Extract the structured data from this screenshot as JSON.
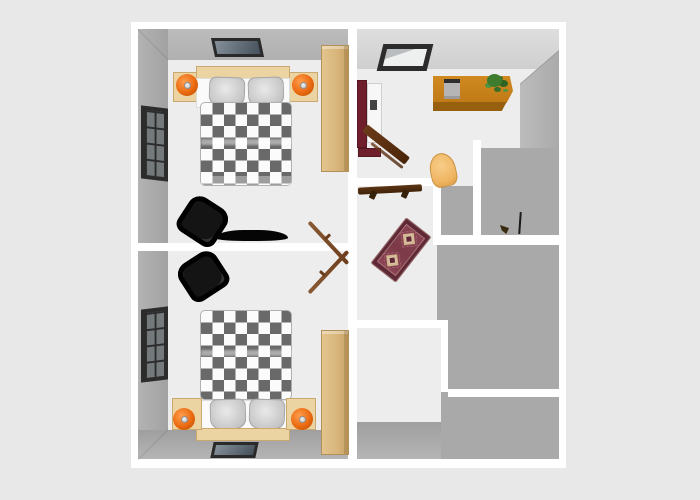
{
  "meta": {
    "description": "3D overhead rendering of an upper-storey floor plan on a plain light-gray background; no visible text, labels or UI controls anywhere in the image",
    "canvas": {
      "width": 700,
      "height": 500
    },
    "plan_outline": {
      "left": 131,
      "top": 22,
      "width": 435,
      "height": 446
    }
  },
  "palette": {
    "page_background": "#e8e8e8",
    "walls": "#ffffff",
    "floor": "#ededed",
    "wall_faces_gray": "#a9a9a9",
    "office_ceiling_gray": "#d8d8d8",
    "bed_checker_dark": "#696969",
    "wood_light": "#ecd3a2",
    "wood_wardrobe": "#d9b97e",
    "stairs_wood": "#f2daa3",
    "lamp_orange": "#ea6a10",
    "piano_maroon": "#6e1f2b",
    "desk_amber": "#bf7a16",
    "rug_maroon": "#8a4454",
    "rug_medallion_cream": "#dcc6a8",
    "shelf_teal": "#2a8f98",
    "shower_tray_tan": "#f4c070",
    "ski_bag_navy": "#2d4257",
    "boots_red": "#d0281c",
    "kids_chair_blue": "#56b4e4",
    "basin_red": "#7c1c22",
    "armchair_black": "#141414"
  },
  "rooms": [
    {
      "id": "bedroom-top-left",
      "name": "Bedroom (top-left)",
      "furniture": [
        "wall picture",
        "double bed with black-and-white checkered duvet",
        "two gray pillows",
        "wood headboard",
        "two nightstands",
        "two orange table lamps",
        "window on left wall",
        "black armchair",
        "black low TV bench",
        "wood wardrobe",
        "open door leaf"
      ]
    },
    {
      "id": "bedroom-bottom-left",
      "name": "Bedroom (bottom-left, mirrored)",
      "furniture": [
        "black armchair",
        "window on left wall",
        "double bed with checkered duvet",
        "two gray pillows",
        "wood headboard",
        "two nightstands",
        "two orange table lamps",
        "wall picture",
        "wood wardrobe",
        "open door leaf"
      ]
    },
    {
      "id": "office",
      "name": "Office / study (top-middle)",
      "furniture": [
        "roof skylight window",
        "maroon upright piano with bench",
        "amber desk with gray laptop",
        "green potted plant",
        "dark brown writing table (angled)",
        "tan rounded chair"
      ]
    },
    {
      "id": "shower-room",
      "name": "Shower room (right)",
      "furniture": [
        "teal glass shelf",
        "tan shower tray",
        "black shower head on riser",
        "faucet fitting"
      ]
    },
    {
      "id": "hallway",
      "name": "Hallway (center)",
      "furniture": [
        "dark wall shelf / coat rack",
        "maroon oriental rug with two cream medallions",
        "dark brown door mat"
      ]
    },
    {
      "id": "staircase-landing",
      "name": "Staircase landing (right)",
      "furniture": [
        "light wood staircase with baluster railing",
        "dark red half-round wall basin"
      ]
    },
    {
      "id": "storage-room",
      "name": "Storage room (bottom-middle)",
      "furniture": [
        "light blue child chair",
        "two pairs of red ski boots",
        "navy ski bag (vertical)",
        "navy ski bag (horizontal)"
      ]
    }
  ]
}
